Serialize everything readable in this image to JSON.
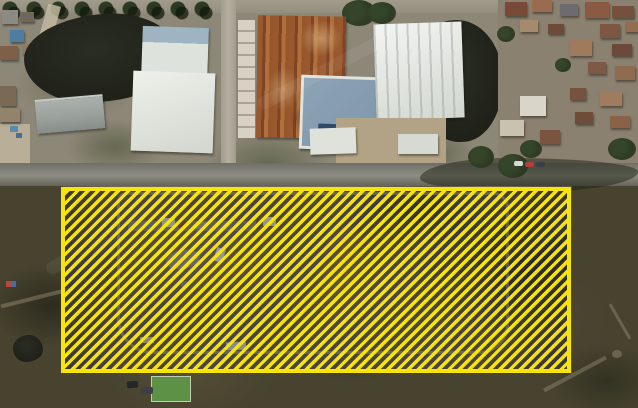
{
  "map": {
    "type": "satellite-aerial-imagery",
    "visible_text": "none",
    "highlight_overlay": {
      "label": "hatched-area-annotation",
      "shape": "rectangle",
      "bounds_px": {
        "x": 61,
        "y": 187,
        "width": 510,
        "height": 186
      },
      "border": {
        "color": "#f6e40c",
        "width_px": 4
      },
      "hatch": {
        "style": "diagonal-stripes",
        "direction": "bottom-left-to-top-right",
        "css_angle_deg": 135,
        "stripe_color": "#f6e40c",
        "stripe_width_px": 3.4,
        "period_px": 7.2,
        "gap_tint": "rgba(12,16,34,0.42)"
      }
    },
    "palette": {
      "ground_top": "#8d8777",
      "ground_bottom": "#47432f",
      "field_dirt": "#77694f",
      "road": "#83837a",
      "road_light": "#b4af9f",
      "pond_dark": "#20221a",
      "pond_green": "#32422a",
      "roof_white": "#e7eae4",
      "roof_gray": "#9aa09c",
      "roof_rust": "#96572d",
      "roof_bluegray": "#8da3b6",
      "roof_navy": "#2f4a68",
      "tree_green": "#2d3a23",
      "grass_field": "#5d9146",
      "path_light": "#cfc3a0",
      "concrete": "#b3a386",
      "village_ground": "#8b8170"
    },
    "features": [
      "tree-lined-street",
      "dark-pond",
      "village-pond",
      "green-pond",
      "white-warehouses",
      "rust-roof-warehouse",
      "bluegray-roof-building",
      "village-houses",
      "main-road",
      "scrub-land",
      "dirt-field-parcel",
      "loop-track",
      "field-sheds",
      "sports-green-plot",
      "parked-cars",
      "highlighted-parcel-overlay"
    ]
  }
}
